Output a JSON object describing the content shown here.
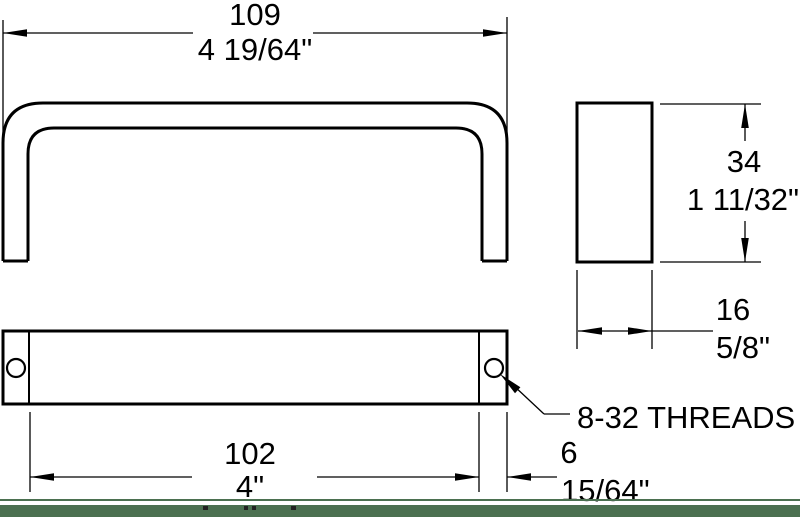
{
  "dimensions": {
    "overall_width": {
      "mm": "109",
      "inch": "4 19/64\""
    },
    "height": {
      "mm": "34",
      "inch": "1 11/32\""
    },
    "depth": {
      "mm": "16",
      "inch": "5/8\""
    },
    "hole_centers": {
      "mm": "102",
      "inch": "4\""
    },
    "end_thickness": {
      "mm": "6",
      "inch": "15/64\""
    }
  },
  "annotations": {
    "thread_note": "8-32 THREADS"
  },
  "colors": {
    "line": "#000000",
    "background": "#ffffff",
    "accent_bar": "#4b7050"
  }
}
